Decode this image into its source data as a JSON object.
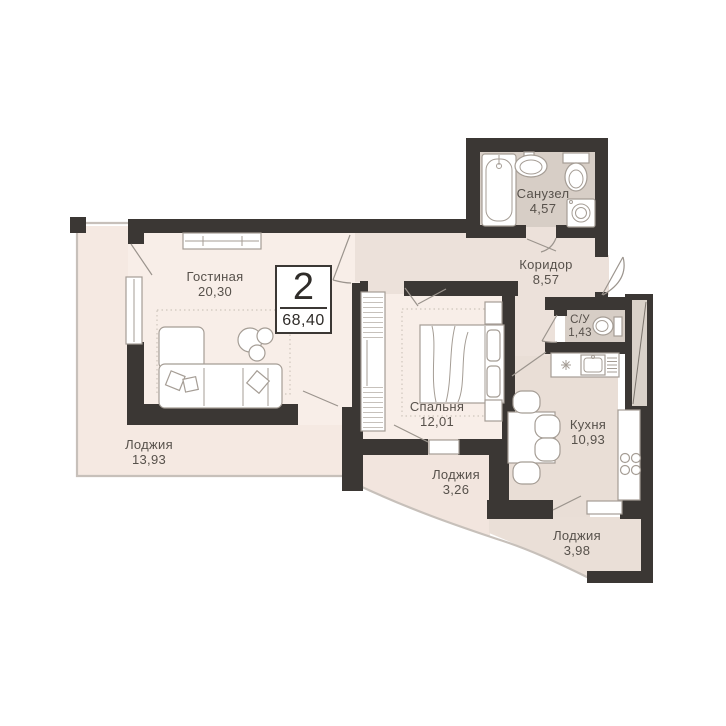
{
  "badge": {
    "rooms": "2",
    "total_area": "68,40"
  },
  "rooms": [
    {
      "name": "Гостиная",
      "area": "20,30"
    },
    {
      "name": "Лоджия",
      "area": "13,93"
    },
    {
      "name": "Спальня",
      "area": "12,01"
    },
    {
      "name": "Лоджия",
      "area": "3,26"
    },
    {
      "name": "Кухня",
      "area": "10,93"
    },
    {
      "name": "Лоджия",
      "area": "3,98"
    },
    {
      "name": "Коридор",
      "area": "8,57"
    },
    {
      "name": "Санузел",
      "area": "4,57"
    },
    {
      "name": "С/У",
      "area": "1,43"
    }
  ],
  "colors": {
    "wall": "#3b3734",
    "room": "#f8eee8",
    "loggia": "#f5e9e2",
    "loggia2": "#f2e5de",
    "loggia3": "#eadfd7",
    "corridor": "#ece1da",
    "kitchen": "#e9ded6",
    "wet": "#d7cec6",
    "shaft": "#d9d1c9",
    "line": "#c7c0ba",
    "furn": "#a59d95",
    "door": "#9b948d",
    "rug": "#cfc6bd",
    "text": "#57514b"
  }
}
